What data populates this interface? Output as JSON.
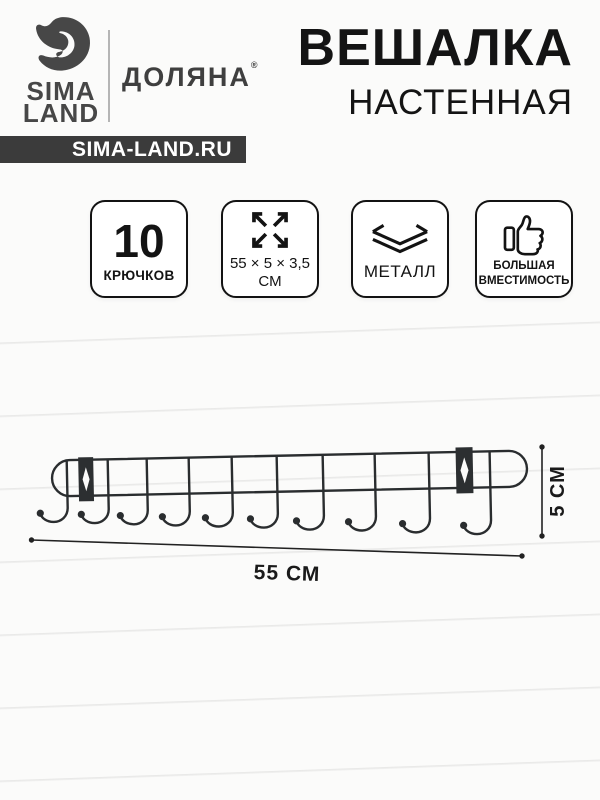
{
  "header": {
    "logo": {
      "line1": "SIMA",
      "line2": "LAND"
    },
    "brand": "ДОЛЯНА",
    "brand_mark": "®",
    "site_badge": "SIMA-LAND.RU"
  },
  "title": {
    "line1": "ВЕШАЛКА",
    "line2": "НАСТЕННАЯ"
  },
  "feature_badges": [
    {
      "value": "10",
      "label": "КРЮЧКОВ"
    },
    {
      "icon": "expand-arrows-icon",
      "line1": "55 × 5 × 3,5",
      "line2": "СМ"
    },
    {
      "icon": "layers-icon",
      "label": "МЕТАЛЛ"
    },
    {
      "icon": "thumb-up-icon",
      "line1": "БОЛЬШАЯ",
      "line2": "ВМЕСТИМОСТЬ"
    }
  ],
  "product": {
    "hooks_count": 10,
    "width_label": "55 СМ",
    "height_label": "5 СМ"
  },
  "colors": {
    "site_badge_bg": "#3b3b3b",
    "logo_gray": "#474747",
    "text_black": "#141414",
    "wire": "#2a2d2f"
  }
}
